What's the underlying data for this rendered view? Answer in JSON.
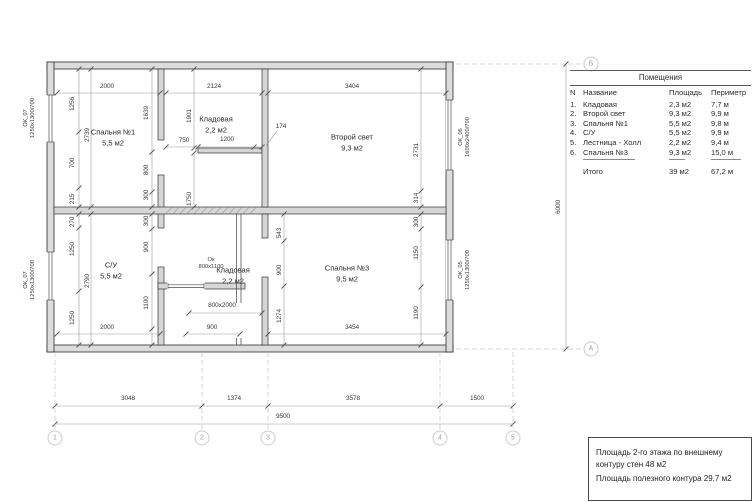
{
  "table": {
    "title": "Помещения",
    "headers": {
      "n": "N",
      "name": "Название",
      "area": "Площадь",
      "perimeter": "Периметр"
    },
    "rows": [
      {
        "n": "1.",
        "name": "Кладовая",
        "area": "2,3 м2",
        "perimeter": "7,7 м"
      },
      {
        "n": "2.",
        "name": "Второй свет",
        "area": "9,3 м2",
        "perimeter": "9,9 м"
      },
      {
        "n": "3.",
        "name": "Спальня №1",
        "area": "5,5 м2",
        "perimeter": "9,8 м"
      },
      {
        "n": "4.",
        "name": "С/У",
        "area": "5,5 м2",
        "perimeter": "9,9 м"
      },
      {
        "n": "5.",
        "name": "Лестница - Холл",
        "area": "2,2 м2",
        "perimeter": "9,4 м"
      },
      {
        "n": "6.",
        "name": "Спальня №3",
        "area": "9,3 м2",
        "perimeter": "15,0 м"
      }
    ],
    "total": {
      "label": "Итого",
      "area": "39 м2",
      "perimeter": "67,2 м"
    }
  },
  "note": {
    "line1": "Площадь 2-го этажа по внешнему",
    "line2": "контуру стен 48 м2",
    "line3": "Площадь полезного контура 29,7 м2"
  },
  "plan": {
    "room_labels": [
      {
        "name": "Спальня №1",
        "area": "5,5 м2",
        "x": 113,
        "y": 138
      },
      {
        "name": "Кладовая",
        "area": "2,2 м2",
        "x": 216,
        "y": 125
      },
      {
        "name": "Второй свет",
        "area": "9,3 м2",
        "x": 352,
        "y": 143
      },
      {
        "name": "С/У",
        "area": "5,5 м2",
        "x": 111,
        "y": 271
      },
      {
        "name": "Кладовая",
        "area": "2,2 м2",
        "x": 233,
        "y": 276
      },
      {
        "name": "Спальня №3",
        "area": "9,5 м2",
        "x": 347,
        "y": 274
      }
    ],
    "window_labels": [
      {
        "code": "ОК_07",
        "size": "1250х1300/700",
        "x": 30,
        "y": 118,
        "v": 1
      },
      {
        "code": "ОК_07",
        "size": "1250х1300/700",
        "x": 30,
        "y": 280,
        "v": 1
      },
      {
        "code": "ОК_06",
        "size": "1600х2400/700",
        "x": 465,
        "y": 137,
        "v": 1
      },
      {
        "code": "ОК_05",
        "size": "1250х1300/700",
        "x": 465,
        "y": 270,
        "v": 1
      },
      {
        "code": "Ок",
        "size": "800х1100",
        "x": 211,
        "y": 264,
        "v": 0
      }
    ],
    "dim_labels": [
      {
        "t": "2000",
        "x": 107,
        "y": 87
      },
      {
        "t": "2124",
        "x": 214,
        "y": 87
      },
      {
        "t": "3404",
        "x": 352,
        "y": 87
      },
      {
        "t": "750",
        "x": 184,
        "y": 141
      },
      {
        "t": "1200",
        "x": 227,
        "y": 140
      },
      {
        "t": "174",
        "x": 281,
        "y": 127
      },
      {
        "t": "1256",
        "x": 73,
        "y": 104,
        "v": 1
      },
      {
        "t": "700",
        "x": 73,
        "y": 163,
        "v": 1
      },
      {
        "t": "215",
        "x": 73,
        "y": 199,
        "v": 1
      },
      {
        "t": "2739",
        "x": 88,
        "y": 135,
        "v": 1
      },
      {
        "t": "1639",
        "x": 147,
        "y": 113,
        "v": 1
      },
      {
        "t": "800",
        "x": 147,
        "y": 170,
        "v": 1
      },
      {
        "t": "300",
        "x": 147,
        "y": 195,
        "v": 1
      },
      {
        "t": "1901",
        "x": 190,
        "y": 116,
        "v": 1
      },
      {
        "t": "1750",
        "x": 190,
        "y": 199,
        "v": 1
      },
      {
        "t": "2731",
        "x": 417,
        "y": 150,
        "v": 1
      },
      {
        "t": "314",
        "x": 417,
        "y": 198,
        "v": 1
      },
      {
        "t": "270",
        "x": 73,
        "y": 222,
        "v": 1
      },
      {
        "t": "1250",
        "x": 73,
        "y": 249,
        "v": 1
      },
      {
        "t": "2790",
        "x": 88,
        "y": 281,
        "v": 1
      },
      {
        "t": "1250",
        "x": 73,
        "y": 318,
        "v": 1
      },
      {
        "t": "300",
        "x": 147,
        "y": 221,
        "v": 1
      },
      {
        "t": "900",
        "x": 147,
        "y": 247,
        "v": 1
      },
      {
        "t": "1100",
        "x": 147,
        "y": 303,
        "v": 1
      },
      {
        "t": "543",
        "x": 280,
        "y": 233,
        "v": 1
      },
      {
        "t": "900",
        "x": 280,
        "y": 270,
        "v": 1
      },
      {
        "t": "1274",
        "x": 280,
        "y": 316,
        "v": 1
      },
      {
        "t": "300",
        "x": 417,
        "y": 222,
        "v": 1
      },
      {
        "t": "1150",
        "x": 417,
        "y": 253,
        "v": 1
      },
      {
        "t": "1190",
        "x": 417,
        "y": 313,
        "v": 1
      },
      {
        "t": "2000",
        "x": 107,
        "y": 328
      },
      {
        "t": "800х2000",
        "x": 222,
        "y": 306
      },
      {
        "t": "900",
        "x": 212,
        "y": 328
      },
      {
        "t": "3454",
        "x": 352,
        "y": 328
      },
      {
        "t": "3048",
        "x": 128,
        "y": 399
      },
      {
        "t": "1374",
        "x": 234,
        "y": 399
      },
      {
        "t": "3578",
        "x": 353,
        "y": 399
      },
      {
        "t": "1500",
        "x": 477,
        "y": 399
      },
      {
        "t": "9500",
        "x": 283,
        "y": 417
      },
      {
        "t": "6000",
        "x": 559,
        "y": 207,
        "v": 1
      }
    ],
    "axes": {
      "bottom": [
        {
          "n": "1",
          "x": 55
        },
        {
          "n": "2",
          "x": 202
        },
        {
          "n": "3",
          "x": 268
        },
        {
          "n": "4",
          "x": 440
        },
        {
          "n": "5",
          "x": 513
        }
      ],
      "right": [
        {
          "n": "Б",
          "y": 64
        },
        {
          "n": "А",
          "y": 349
        }
      ]
    }
  }
}
